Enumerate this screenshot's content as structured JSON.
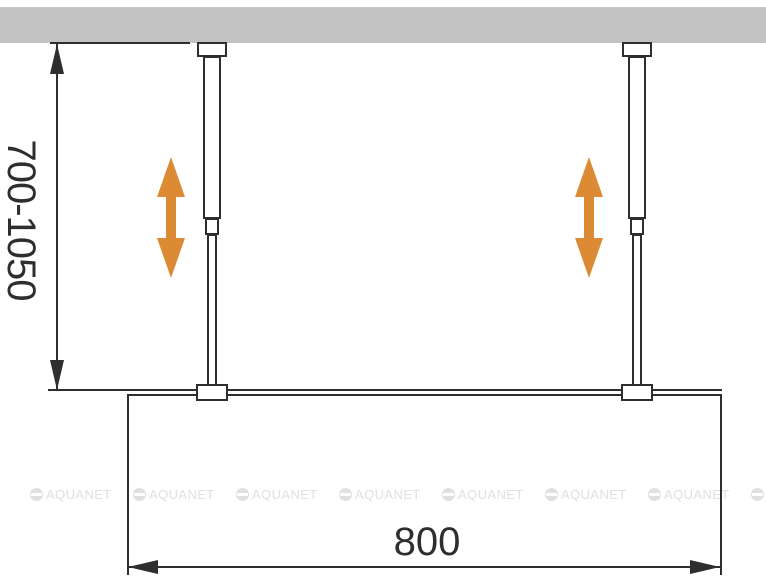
{
  "diagram": {
    "type": "technical-installation-drawing",
    "subject": "walk-in glass shower panel with two telescopic ceiling support rods, front view",
    "labels": {
      "height_range": "700-1050",
      "width": "800"
    },
    "watermark": {
      "text": "AQUANET",
      "logo": "circle-with-horizontal-bar",
      "instances": 8
    },
    "icons": {
      "height_adjust_arrow": "double-headed-vertical-arrow",
      "dimension_arrowheads": "filled-cad-triangles"
    },
    "colors": {
      "background": "#ffffff",
      "ceiling_gray": "#c3c3c3",
      "line_dark": "#2e2e2e",
      "arrow_orange": "#DD8A35",
      "watermark_gray": "#e0e0e0"
    }
  }
}
